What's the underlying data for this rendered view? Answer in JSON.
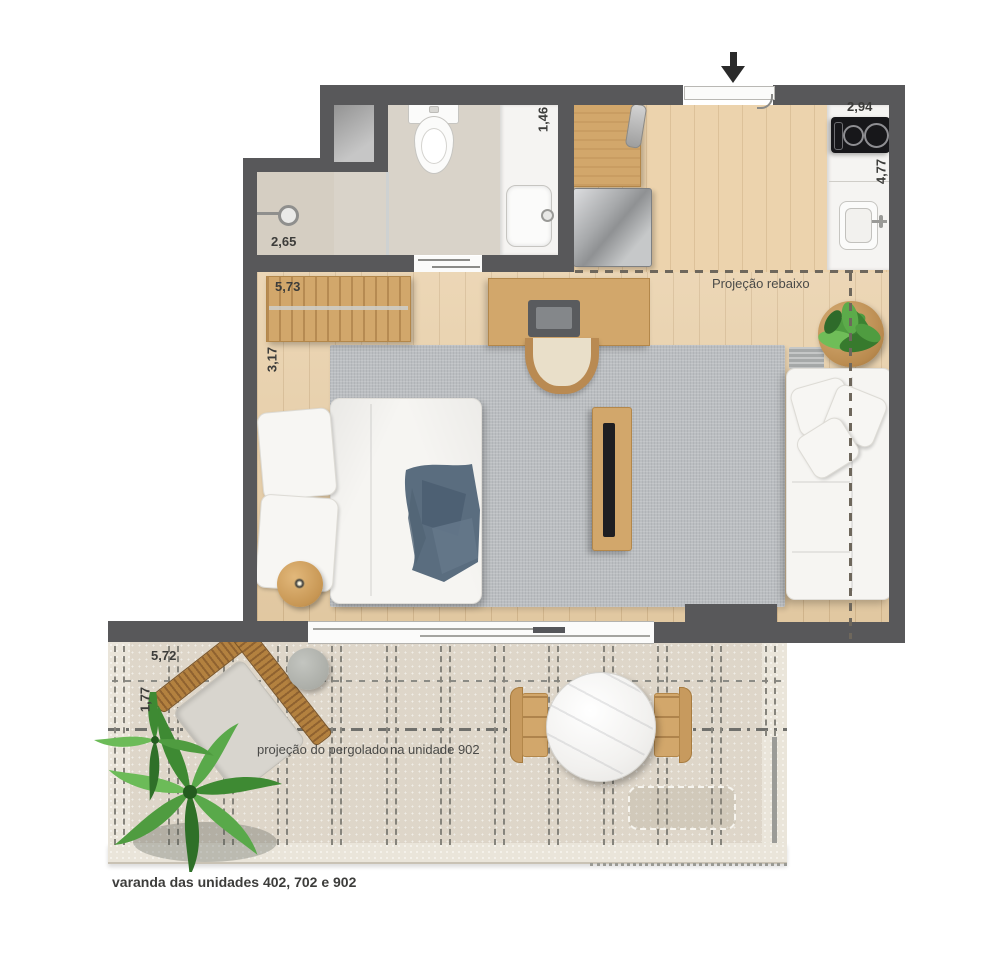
{
  "plan": {
    "dimensions": {
      "shower_width": "2,65",
      "closet_width": "5,73",
      "room_width": "3,17",
      "bath_counter_depth": "1,46",
      "kitchen_width": "2,94",
      "kitchen_depth": "4,77",
      "terrace_width": "5,72",
      "terrace_depth": "1,77"
    },
    "annotations": {
      "ceiling_projection": "Projeção rebaixo",
      "pergola_projection": "projeção do pergolado na unidade 902",
      "caption": "varanda das unidades 402, 702 e 902"
    },
    "colors": {
      "wall": "#58585a",
      "wood_floor": "#e8cea6",
      "tile_floor": "#d9d3c9",
      "rug": "#bbbec1",
      "terrace_floor": "#ded6c9",
      "furniture_wood": "#d2a76b",
      "blanket_blue": "#5a6d7f",
      "plant_green": "#4c9440"
    }
  }
}
